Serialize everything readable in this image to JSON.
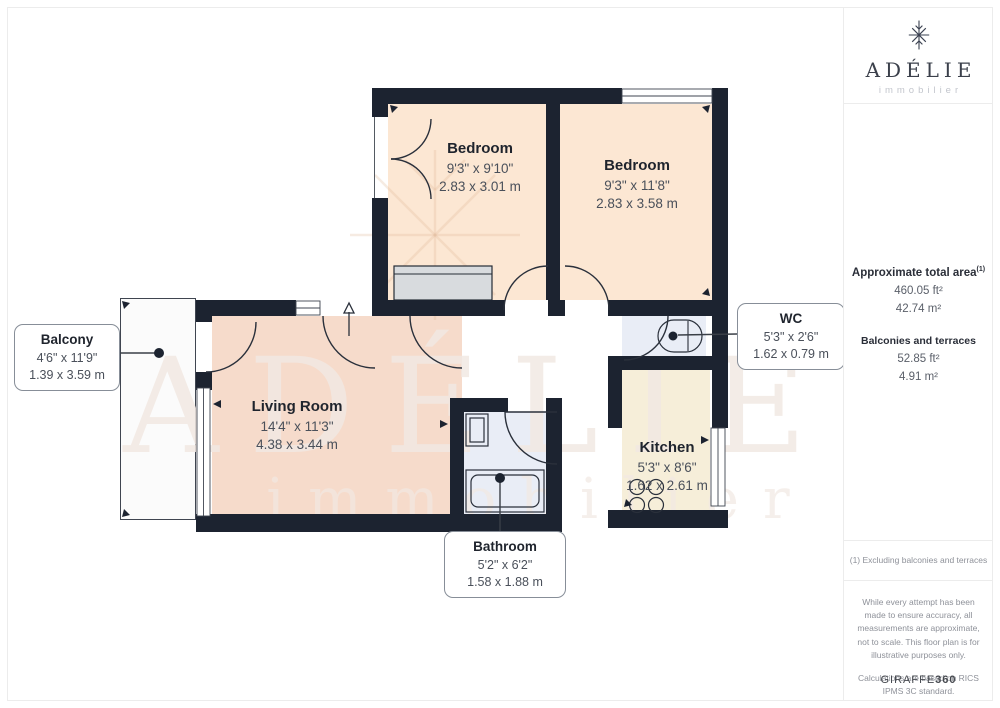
{
  "brand": {
    "name": "ADÉLIE",
    "tagline": "immobilier"
  },
  "plan": {
    "rooms": {
      "bedroom1": {
        "name": "Bedroom",
        "imperial": "9'3\" x 9'10\"",
        "metric": "2.83 x 3.01 m"
      },
      "bedroom2": {
        "name": "Bedroom",
        "imperial": "9'3\" x 11'8\"",
        "metric": "2.83 x 3.58 m"
      },
      "living_room": {
        "name": "Living Room",
        "imperial": "14'4\" x 11'3\"",
        "metric": "4.38 x 3.44 m"
      },
      "kitchen": {
        "name": "Kitchen",
        "imperial": "5'3\" x 8'6\"",
        "metric": "1.62 x 2.61 m"
      },
      "wc": {
        "name": "WC",
        "imperial": "5'3\" x 2'6\"",
        "metric": "1.62 x 0.79 m"
      },
      "bathroom": {
        "name": "Bathroom",
        "imperial": "5'2\" x 6'2\"",
        "metric": "1.58 x 1.88 m"
      },
      "balcony": {
        "name": "Balcony",
        "imperial": "4'6\" x 11'9\"",
        "metric": "1.39 x 3.59 m"
      }
    },
    "colors": {
      "wall": "#1c2330",
      "bedroom_fill": "#fce7d3",
      "living_fill": "#f6dbcb",
      "kitchen_fill": "#f6eed9",
      "bath_fill": "#e9edf6",
      "wardrobe_fill": "#d8dbde",
      "balcony_fill": "#fbfbfb",
      "watermark": "#f2e9e3"
    },
    "watermark": {
      "title": "ADÉLIE",
      "subtitle": "immobilier"
    }
  },
  "sidebar": {
    "total_area_label": "Approximate total area",
    "total_area_sup": "(1)",
    "total_area_ft": "460.05 ft²",
    "total_area_m": "42.74 m²",
    "balconies_label": "Balconies and terraces",
    "balconies_ft": "52.85 ft²",
    "balconies_m": "4.91 m²",
    "footnote": "(1) Excluding balconies and terraces",
    "disclaimer": "While every attempt has been made to ensure accuracy, all measurements are approximate, not to scale. This floor plan is for illustrative purposes only.",
    "standard_note": "Calculations are based on RICS IPMS 3C standard.",
    "generator_name": "GIRAFFE",
    "generator_number": "360"
  }
}
